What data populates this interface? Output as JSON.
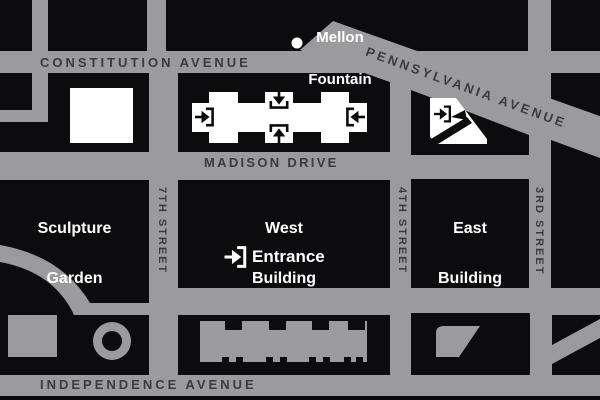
{
  "streets": {
    "constitution_avenue": "CONSTITUTION AVENUE",
    "pennsylvania_avenue": "PENNSYLVANIA AVENUE",
    "madison_drive": "MADISON DRIVE",
    "independence_avenue": "INDEPENDENCE AVENUE",
    "seventh_street": "7TH STREET",
    "fourth_street": "4TH STREET",
    "third_street": "3RD STREET"
  },
  "places": {
    "mellon_fountain": [
      "Mellon",
      "Fountain"
    ],
    "sculpture_garden": [
      "Sculpture",
      "Garden"
    ],
    "west_building": [
      "West",
      "Building"
    ],
    "east_building": [
      "East",
      "Building"
    ],
    "entrance": "Entrance"
  },
  "icons": {
    "entry_arrow": "entry-arrow-icon",
    "fountain_dot": "fountain-dot-icon"
  },
  "colors": {
    "street": "#9b9b9d",
    "block": "#0c0c0e",
    "street_label": "#3b3a3c",
    "building_fill": "#ffffff"
  }
}
